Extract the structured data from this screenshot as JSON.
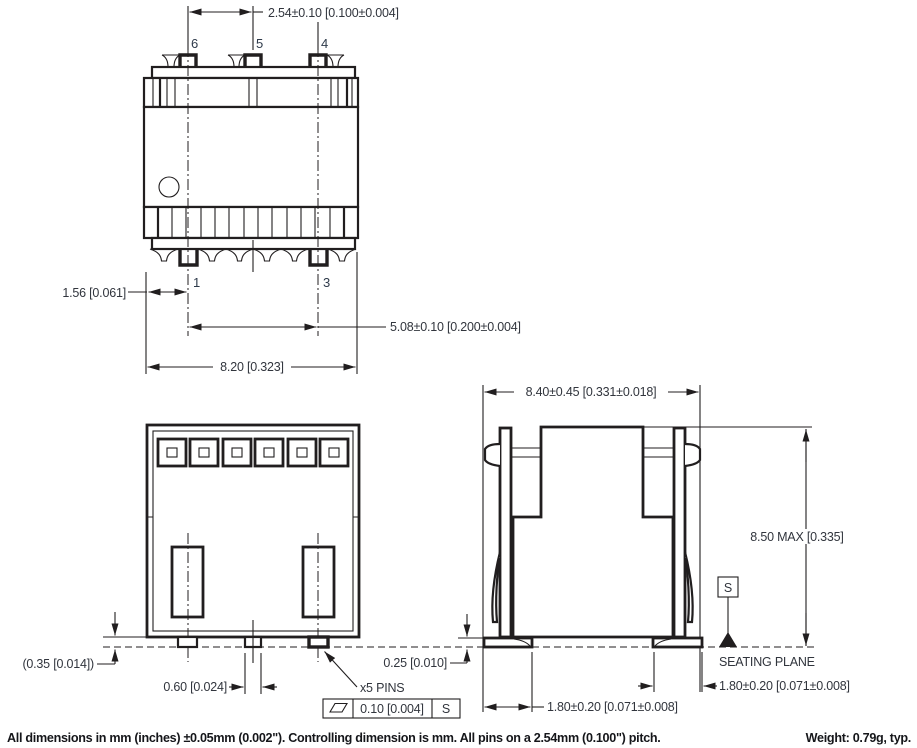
{
  "colors": {
    "line": "#211e1f",
    "text": "#31353d",
    "pin_text": "#2e3a4a",
    "bg": "#ffffff"
  },
  "top_view": {
    "pins": {
      "p6": "6",
      "p5": "5",
      "p4": "4",
      "p1": "1",
      "p3": "3"
    },
    "dim_pitch": "2.54±0.10 [0.100±0.004]",
    "dim_pin_offset": "1.56 [0.061]",
    "dim_pin_span": "5.08±0.10 [0.200±0.004]",
    "dim_body_width": "8.20 [0.323]"
  },
  "bottom_view": {
    "dim_standoff": "(0.35 [0.014])",
    "dim_pin_width": "0.60 [0.024]",
    "pins_callout": "x5 PINS",
    "flatness_tolerance": "0.10 [0.004]",
    "flatness_datum": "S"
  },
  "side_view": {
    "dim_overall_width": "8.40±0.45 [0.331±0.018]",
    "dim_max_height": "8.50 MAX [0.335]",
    "dim_lead_thickness": "0.25 [0.010]",
    "dim_foot_left": "1.80±0.20 [0.071±0.008]",
    "dim_foot_right": "1.80±0.20 [0.071±0.008]",
    "datum_label": "S",
    "seating_plane_label": "SEATING PLANE"
  },
  "footer": {
    "note": "All dimensions in mm (inches) ±0.05mm (0.002\"). Controlling dimension is mm. All pins on a 2.54mm (0.100\") pitch.",
    "weight": "Weight: 0.79g, typ."
  }
}
